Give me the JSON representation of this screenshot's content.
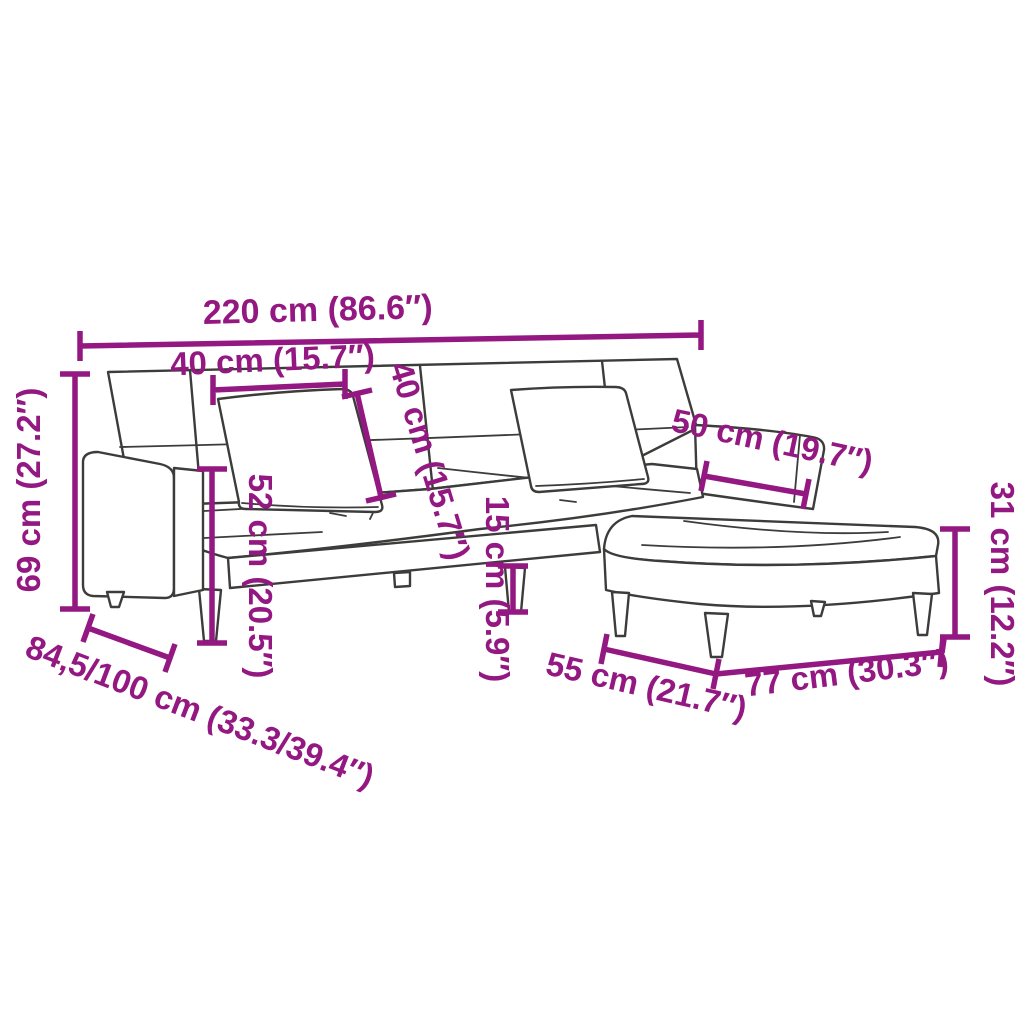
{
  "page": {
    "background": "#ffffff"
  },
  "palette": {
    "dimension_color": "#941881",
    "line_color": "#3c3c3b",
    "fill_color": "#ffffff"
  },
  "diagram": {
    "subject": "sofa-bed-with-two-pillows-and-footstool-dimension-drawing",
    "dimensions": {
      "overall_width": {
        "label": "220 cm (86.6″)"
      },
      "pillow_width": {
        "label": "40 cm (15.7″)"
      },
      "pillow_height": {
        "label": "40 cm (15.7″)"
      },
      "armrest_length": {
        "label": "50 cm (19.7″)"
      },
      "overall_height": {
        "label": "69 cm (27.2″)"
      },
      "seat_front_height": {
        "label": "52 cm (20.5″)"
      },
      "leg_height": {
        "label": "15 cm (5.9″)"
      },
      "footstool_height": {
        "label": "31 cm (12.2″)"
      },
      "overall_depth": {
        "label": "84,5/100 cm (33.3/39.4″)"
      },
      "footstool_depth": {
        "label": "55 cm (21.7″)"
      },
      "footstool_width": {
        "label": "77 cm (30.3″)"
      }
    }
  }
}
